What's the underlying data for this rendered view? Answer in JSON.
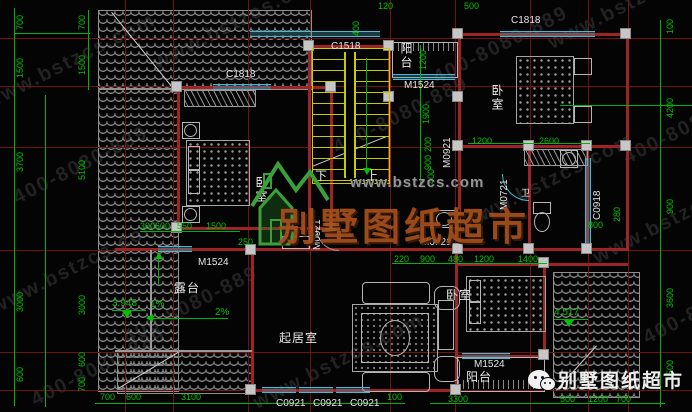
{
  "drawing": {
    "type": "villa-floor-plan"
  },
  "colors": {
    "background": "#040404",
    "dimension_green": "#00c400",
    "wall_red": "#9c2424",
    "grid_red": "#6e1212",
    "window_cyan": "#49b8d2",
    "stairs_yellow": "#c9c900",
    "roof_hatch_gray": "#8f8f8f",
    "label_white": "#e8e8e8",
    "brand_orange": "#a34e1b",
    "watermark_gray": "#949494"
  },
  "watermark": {
    "url": "www.bstzcs.com",
    "brand": "别墅图纸超市"
  },
  "footer": {
    "wechat_label": "别墅图纸超市"
  },
  "annotations": {
    "dims": {
      "cls": "dim",
      "name": "dimension-label",
      "items": [
        {
          "t": "700",
          "x": 16,
          "y": 30,
          "r": 1
        },
        {
          "t": "1500",
          "x": 16,
          "y": 78,
          "r": 1
        },
        {
          "t": "3700",
          "x": 16,
          "y": 172,
          "r": 1
        },
        {
          "t": "3000",
          "x": 16,
          "y": 312,
          "r": 1
        },
        {
          "t": "600",
          "x": 16,
          "y": 382,
          "r": 1
        },
        {
          "t": "700",
          "x": 78,
          "y": 30,
          "r": 1
        },
        {
          "t": "1500",
          "x": 78,
          "y": 75,
          "r": 1
        },
        {
          "t": "5100",
          "x": 78,
          "y": 180,
          "r": 1
        },
        {
          "t": "3000",
          "x": 78,
          "y": 315,
          "r": 1
        },
        {
          "t": "600",
          "x": 78,
          "y": 367,
          "r": 1
        },
        {
          "t": "700",
          "x": 78,
          "y": 392,
          "r": 1
        },
        {
          "t": "100",
          "x": 666,
          "y": 34,
          "r": 1
        },
        {
          "t": "4200",
          "x": 666,
          "y": 118,
          "r": 1
        },
        {
          "t": "900",
          "x": 666,
          "y": 214,
          "r": 1
        },
        {
          "t": "3600",
          "x": 666,
          "y": 308,
          "r": 1
        },
        {
          "t": "1500",
          "x": 666,
          "y": 380,
          "r": 1
        },
        {
          "t": "120",
          "x": 378,
          "y": 2
        },
        {
          "t": "500",
          "x": 464,
          "y": 2
        },
        {
          "t": "400",
          "x": 352,
          "y": 36,
          "r": 1
        },
        {
          "t": "1200",
          "x": 419,
          "y": 70,
          "r": 1
        },
        {
          "t": "1900",
          "x": 422,
          "y": 124,
          "r": 1
        },
        {
          "t": "200",
          "x": 424,
          "y": 152,
          "r": 1
        },
        {
          "t": "900",
          "x": 424,
          "y": 170,
          "r": 1
        },
        {
          "t": "400",
          "x": 427,
          "y": 184,
          "r": 1
        },
        {
          "t": "300",
          "x": 140,
          "y": 222
        },
        {
          "t": "600",
          "x": 155,
          "y": 222
        },
        {
          "t": "550",
          "x": 177,
          "y": 222
        },
        {
          "t": "1500",
          "x": 206,
          "y": 222
        },
        {
          "t": "250",
          "x": 238,
          "y": 238
        },
        {
          "t": "1200",
          "x": 472,
          "y": 137
        },
        {
          "t": "2600",
          "x": 539,
          "y": 137
        },
        {
          "t": "280",
          "x": 613,
          "y": 222,
          "r": 1
        },
        {
          "t": "800",
          "x": 588,
          "y": 221
        },
        {
          "t": "220",
          "x": 394,
          "y": 255
        },
        {
          "t": "900",
          "x": 420,
          "y": 255
        },
        {
          "t": "480",
          "x": 448,
          "y": 255
        },
        {
          "t": "1200",
          "x": 474,
          "y": 255
        },
        {
          "t": "1400",
          "x": 518,
          "y": 255
        },
        {
          "t": "700",
          "x": 100,
          "y": 393
        },
        {
          "t": "600",
          "x": 126,
          "y": 393
        },
        {
          "t": "3100",
          "x": 181,
          "y": 393
        },
        {
          "t": "100",
          "x": 387,
          "y": 393
        },
        {
          "t": "3300",
          "x": 448,
          "y": 395
        },
        {
          "t": "500",
          "x": 560,
          "y": 395
        },
        {
          "t": "1200",
          "x": 588,
          "y": 395
        },
        {
          "t": "700",
          "x": 616,
          "y": 395
        }
      ]
    },
    "elev": {
      "cls": "elev",
      "name": "elevation-label",
      "items": [
        {
          "t": "3.948",
          "x": 112,
          "y": 299
        },
        {
          "t": "1%",
          "x": 150,
          "y": 300
        },
        {
          "t": "2%",
          "x": 215,
          "y": 308
        },
        {
          "t": "4.517",
          "x": 554,
          "y": 308
        }
      ]
    },
    "tags": {
      "cls": "tag",
      "name": "opening-tag",
      "items": [
        {
          "t": "C1818",
          "x": 226,
          "y": 70
        },
        {
          "t": "C1518",
          "x": 331,
          "y": 42
        },
        {
          "t": "C1818",
          "x": 511,
          "y": 16
        },
        {
          "t": "M1524",
          "x": 404,
          "y": 81
        },
        {
          "t": "M0921",
          "x": 443,
          "y": 168,
          "r": 1
        },
        {
          "t": "M0721",
          "x": 500,
          "y": 210,
          "r": 1
        },
        {
          "t": "C0918",
          "x": 593,
          "y": 220,
          "r": 1
        },
        {
          "t": "M0921",
          "x": 421,
          "y": 238
        },
        {
          "t": "M0921",
          "x": 313,
          "y": 250,
          "r": 1
        },
        {
          "t": "M1524",
          "x": 198,
          "y": 258
        },
        {
          "t": "M1524",
          "x": 474,
          "y": 360
        },
        {
          "t": "C0921",
          "x": 276,
          "y": 399
        },
        {
          "t": "C0921",
          "x": 313,
          "y": 399
        },
        {
          "t": "C0921",
          "x": 350,
          "y": 399
        }
      ]
    },
    "rooms": {
      "cls": "room",
      "name": "room-label",
      "items": [
        {
          "t": "卧室",
          "x": 255,
          "y": 176,
          "v": 1
        },
        {
          "t": "卧室",
          "x": 491,
          "y": 84,
          "v": 1
        },
        {
          "t": "卧室",
          "x": 446,
          "y": 289
        },
        {
          "t": "起居室",
          "x": 279,
          "y": 332
        },
        {
          "t": "露台",
          "x": 174,
          "y": 282
        },
        {
          "t": "阳台",
          "x": 400,
          "y": 42,
          "v": 1
        },
        {
          "t": "阳台",
          "x": 466,
          "y": 371
        },
        {
          "t": "下",
          "x": 315,
          "y": 170
        },
        {
          "t": "上",
          "x": 366,
          "y": 170
        },
        {
          "t": "卫",
          "x": 521,
          "y": 189,
          "fs": 9
        }
      ]
    },
    "diag": {
      "cls": "diag",
      "name": "diagonal-watermark",
      "items": [
        {
          "t": "www.bstzcs.com",
          "x": -18,
          "y": 95
        },
        {
          "t": "400-8080-889",
          "x": 10,
          "y": 190
        },
        {
          "t": "www.bstzcs.com",
          "x": -12,
          "y": 300
        },
        {
          "t": "400-8080-889",
          "x": 28,
          "y": 392
        },
        {
          "t": "www.bstzcs.com",
          "x": 150,
          "y": 55
        },
        {
          "t": "400-8080-889",
          "x": 120,
          "y": 330
        },
        {
          "t": "www.bstzcs.com",
          "x": 250,
          "y": 395
        },
        {
          "t": "400-8080-889",
          "x": 430,
          "y": 70
        },
        {
          "t": "www.bstzcs.com",
          "x": 545,
          "y": 35
        },
        {
          "t": "400-8080-889",
          "x": 620,
          "y": 150
        },
        {
          "t": "www.bstzcs.com",
          "x": 590,
          "y": 250
        },
        {
          "t": "400-8080-889",
          "x": 640,
          "y": 330
        },
        {
          "t": "www.bstzcs.com",
          "x": 460,
          "y": 215
        },
        {
          "t": "400-8080-889",
          "x": 330,
          "y": 140
        }
      ]
    }
  }
}
